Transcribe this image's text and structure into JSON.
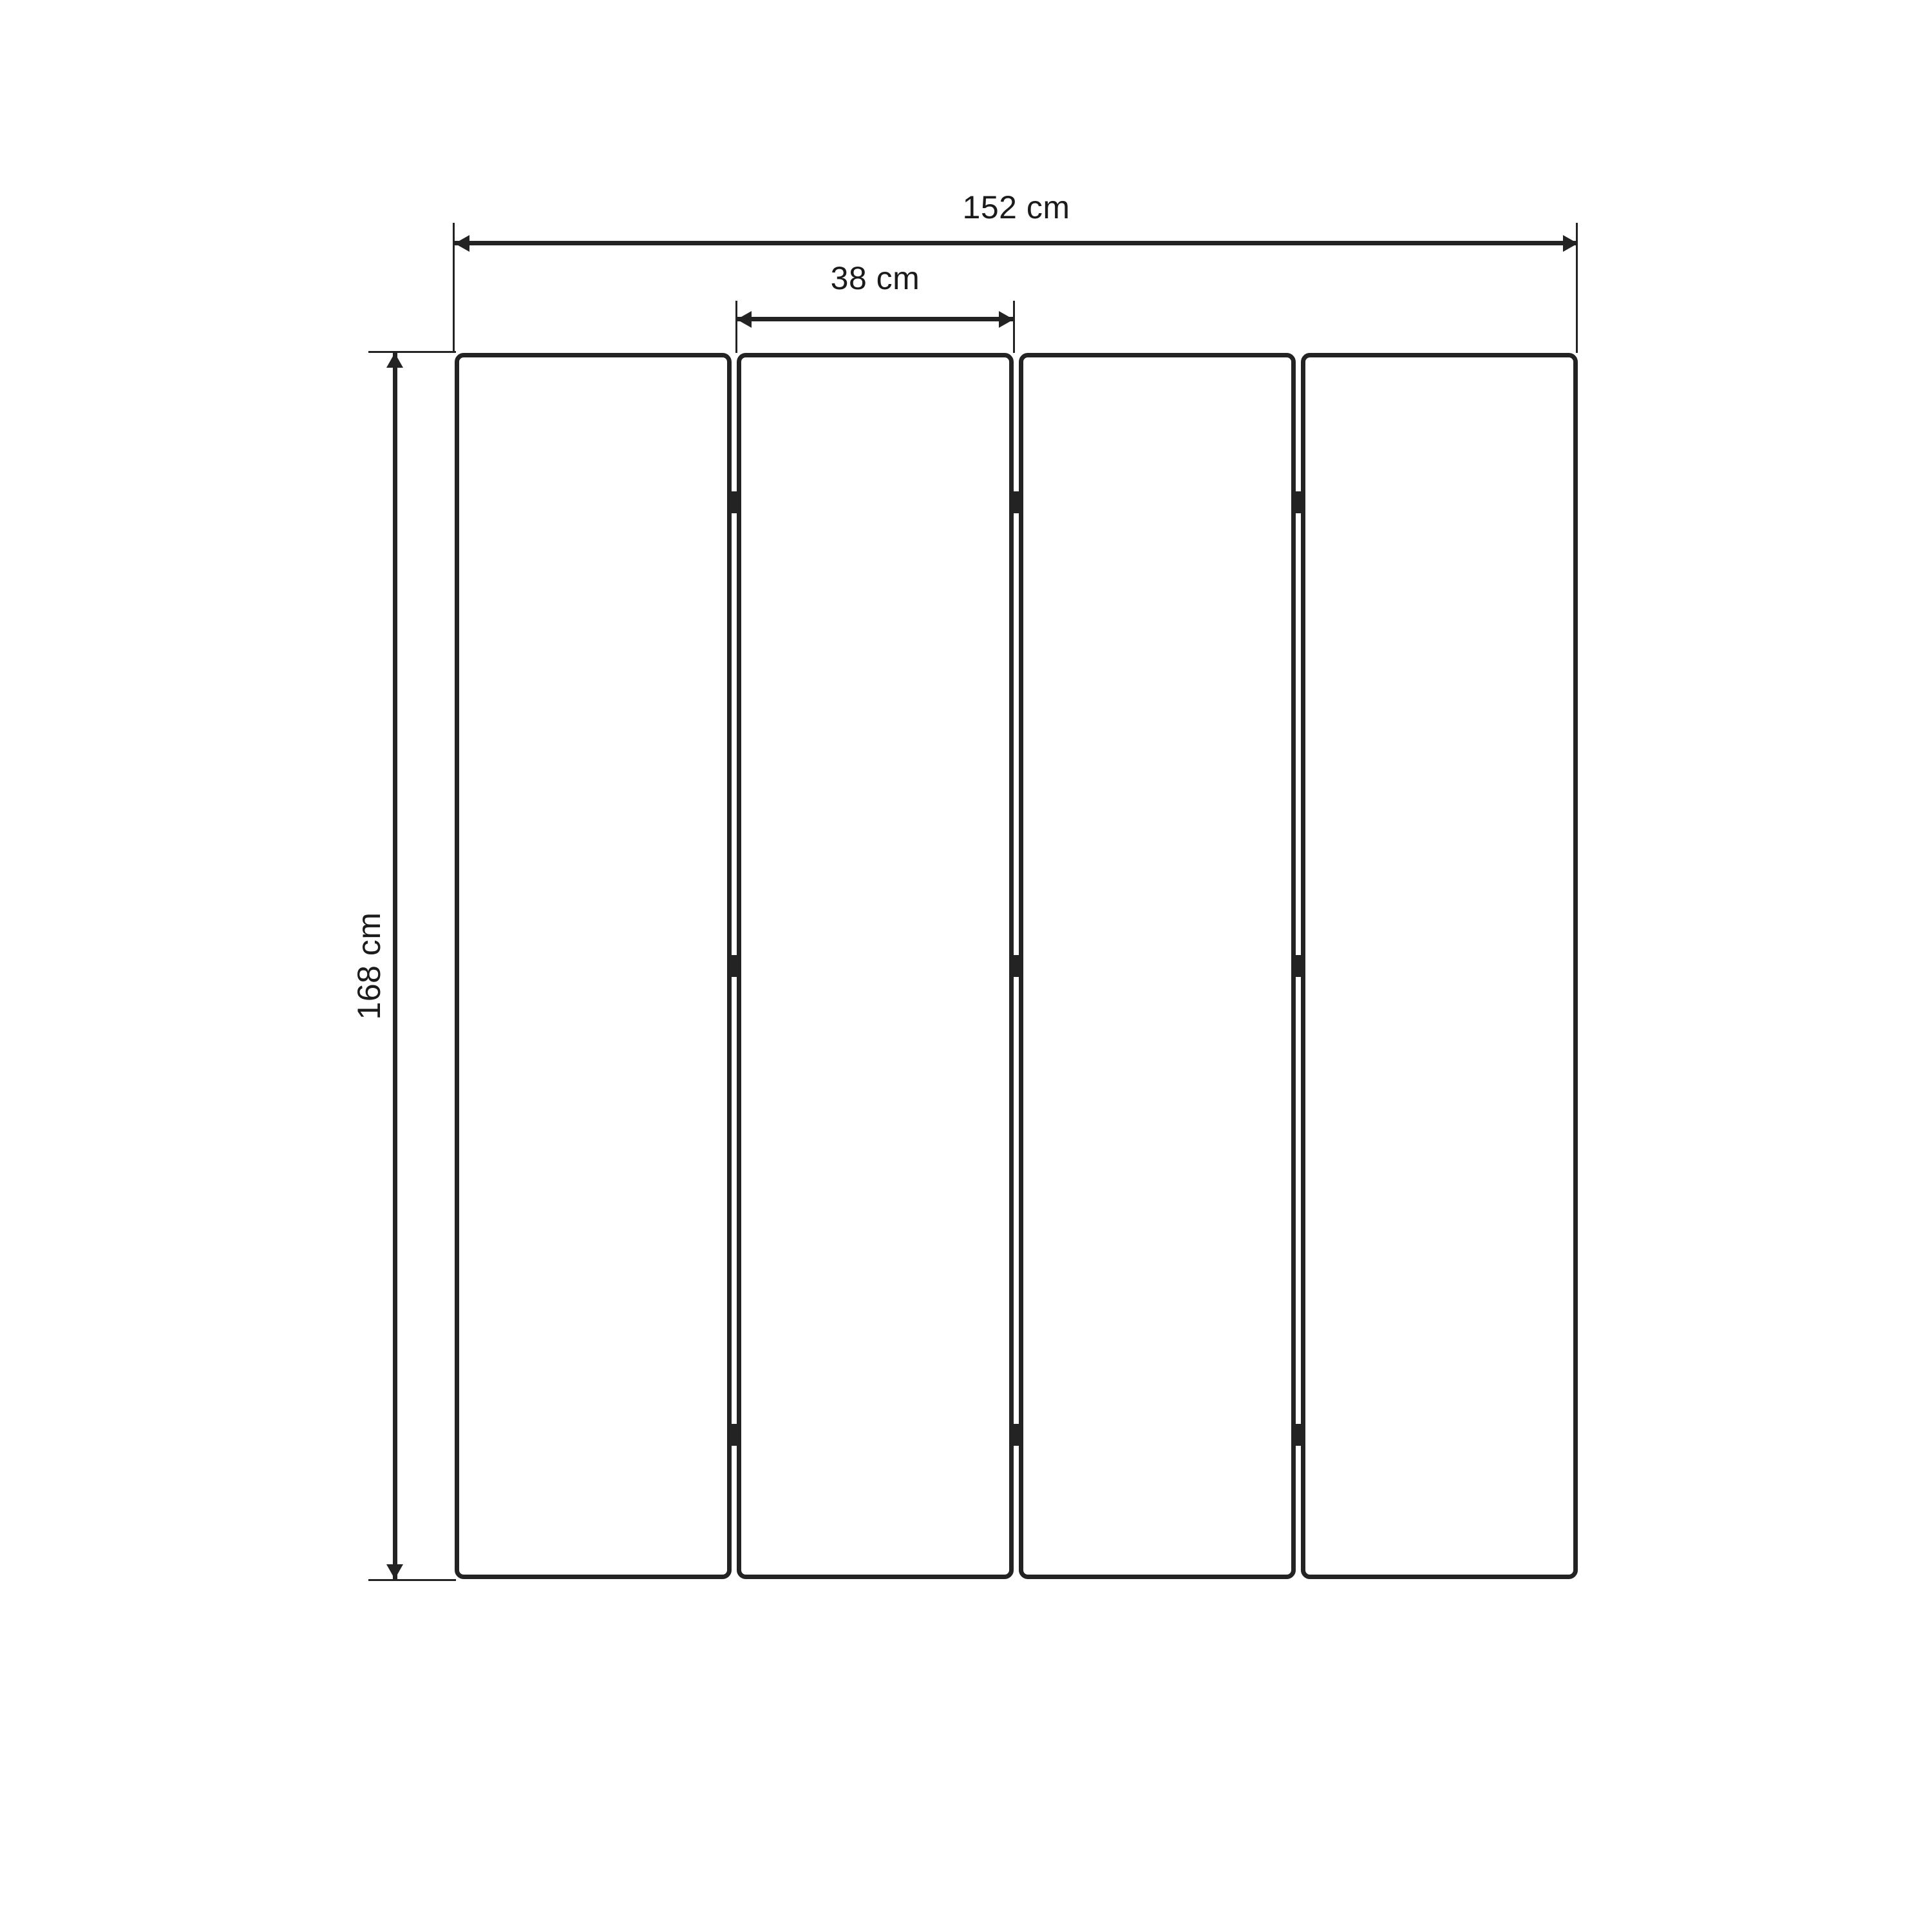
{
  "diagram": {
    "background": "#ffffff",
    "line_color": "#232323",
    "panel_count": 4,
    "hinges_per_gap": 3,
    "labels": {
      "total_width": "152 cm",
      "panel_width": "38 cm",
      "height": "168 cm"
    }
  }
}
